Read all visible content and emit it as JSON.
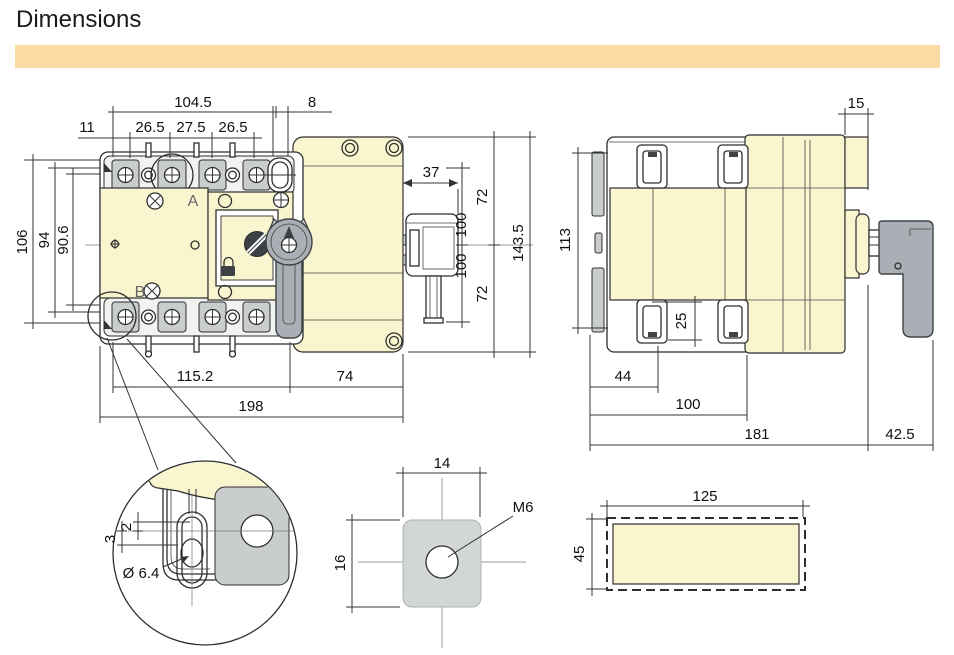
{
  "title": "Dimensions",
  "colors": {
    "accent_bar": "#FDD9A3",
    "body_cream": "#F9F6CF",
    "terminal_gray": "#C9CDCE",
    "handle_gray": "#A9AFB4",
    "line": "#2e2e2e"
  },
  "front_view": {
    "dims": {
      "top_overall": "104.5",
      "top_gap": "8",
      "top_offset": "11",
      "pole_pitch_1": "26.5",
      "pole_pitch_2": "27.5",
      "pole_pitch_3": "26.5",
      "left_outer": "106",
      "left_mid": "94",
      "left_inner": "90.6",
      "aux_width": "37",
      "right_upper": "72",
      "right_center_upper": "100",
      "right_center_lower": "100",
      "right_lower": "72",
      "right_overall": "143.5",
      "bottom_left": "115.2",
      "bottom_right": "74",
      "bottom_overall": "198"
    },
    "labels": {
      "terminal_a": "A",
      "terminal_b": "B"
    }
  },
  "side_view": {
    "dims": {
      "top_right": "15",
      "left_height": "113",
      "clamp_depth": "25",
      "bottom_1": "44",
      "bottom_2": "100",
      "bottom_3": "181",
      "bottom_4": "42.5"
    }
  },
  "detail_view": {
    "dims": {
      "offset": "2",
      "depth": "3",
      "slot_dia": "Ø 6.4"
    }
  },
  "nut_view": {
    "dims": {
      "width": "14",
      "height": "16"
    },
    "thread_label": "M6"
  },
  "cover_view": {
    "dims": {
      "width": "125",
      "height": "45"
    }
  }
}
